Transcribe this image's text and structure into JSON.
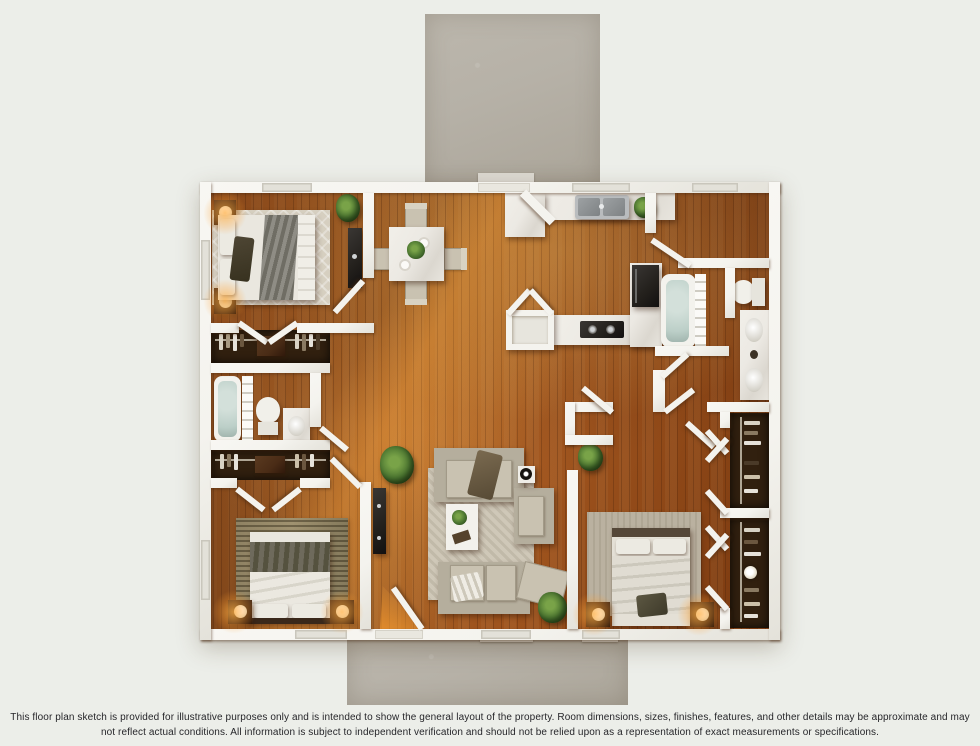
{
  "scene": {
    "description": "3D rendered top-down floor plan of a 3-bedroom, 2-bath single-story home with front and rear concrete patios",
    "disclaimer": "This floor plan sketch is provided for illustrative purposes only and is intended to show the general layout of the property. Room dimensions, sizes, finishes, features, and other details may be approximate and may not reflect actual conditions. All information is subject to independent verification and should not be relied upon as a representation of exact measurements or specifications."
  },
  "palette": {
    "bg": "#eceee9",
    "wall": "#f4f3ee",
    "wall_edge": "#c9c6bc",
    "wood_light": "#c47a31",
    "wood_mid": "#a2561f",
    "wood_dark": "#78380f",
    "concrete": "#b6b1a7",
    "rug": "#cfc8b8",
    "water": "#bccfc8",
    "closet": "#31200f",
    "plant_green": "#4a7430",
    "glow": "#ffa23c",
    "dark_wood": "#4a2c16",
    "appliance": "#23201c",
    "marble": "#ece9e3",
    "text": "#26262a"
  },
  "floor_plan": {
    "rooms": [
      {
        "name": "bedroom-1",
        "position": "top-left",
        "furniture": [
          "bed",
          "two nightstands with lamps",
          "trellis rug",
          "tv-console",
          "plant"
        ]
      },
      {
        "name": "hall-closet-1",
        "furniture": [
          "hanging clothes",
          "dresser"
        ]
      },
      {
        "name": "bathroom-1",
        "furniture": [
          "bathtub with shower curtain",
          "toilet",
          "vanity sink"
        ]
      },
      {
        "name": "hall-closet-2",
        "furniture": [
          "hanging clothes",
          "shelf"
        ]
      },
      {
        "name": "bedroom-2",
        "position": "bottom-left",
        "furniture": [
          "bed",
          "two nightstands with lamps",
          "woven rug"
        ]
      },
      {
        "name": "dining-area",
        "furniture": [
          "square marble table",
          "four chairs",
          "centerpiece plant"
        ]
      },
      {
        "name": "kitchen",
        "furniture": [
          "counter with double sink",
          "L-shaped counter with cooktop",
          "refrigerator",
          "pantry"
        ]
      },
      {
        "name": "bathroom-2",
        "furniture": [
          "bathtub with shower curtain",
          "toilet",
          "double vanity"
        ]
      },
      {
        "name": "living-room",
        "position": "center-bottom",
        "furniture": [
          "two sofas",
          "armchair",
          "ottoman",
          "coffee table",
          "side table",
          "wall tv",
          "area rug",
          "plants"
        ]
      },
      {
        "name": "master-bedroom",
        "position": "bottom-right",
        "furniture": [
          "bed",
          "two nightstands with lamps",
          "rug",
          "plant"
        ]
      },
      {
        "name": "walk-in-closets",
        "position": "right",
        "furniture": [
          "hanging clothes",
          "bifold doors"
        ]
      }
    ],
    "exterior": [
      "rear concrete patio (top)",
      "front concrete porch (bottom)"
    ]
  }
}
